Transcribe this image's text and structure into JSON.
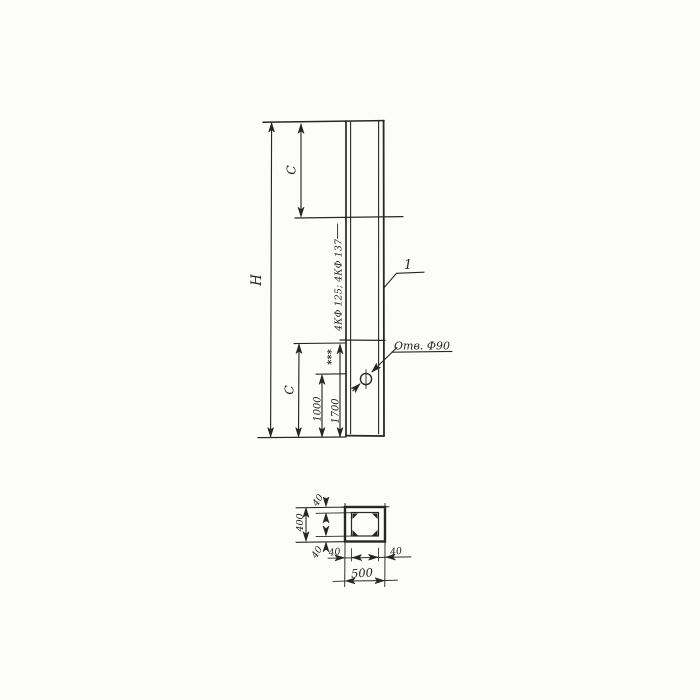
{
  "colors": {
    "ink": "#272727",
    "paper": "#fbfbf9"
  },
  "elevation": {
    "dim_h": "H",
    "dim_c_top": "C",
    "dim_c_bottom": "C",
    "dim_1000": "1000",
    "dim_1700": "1700",
    "footnote_marks": "***",
    "mark_label": "4КФ 125; 4КФ 137",
    "part_callout": "1",
    "hole_label": "Отв. Ф90"
  },
  "section": {
    "dim_width": "500",
    "dim_height": "400",
    "dim_wall_top": "40",
    "dim_wall_bottom": "40",
    "dim_wall_left": "40",
    "dim_wall_right": "40"
  }
}
